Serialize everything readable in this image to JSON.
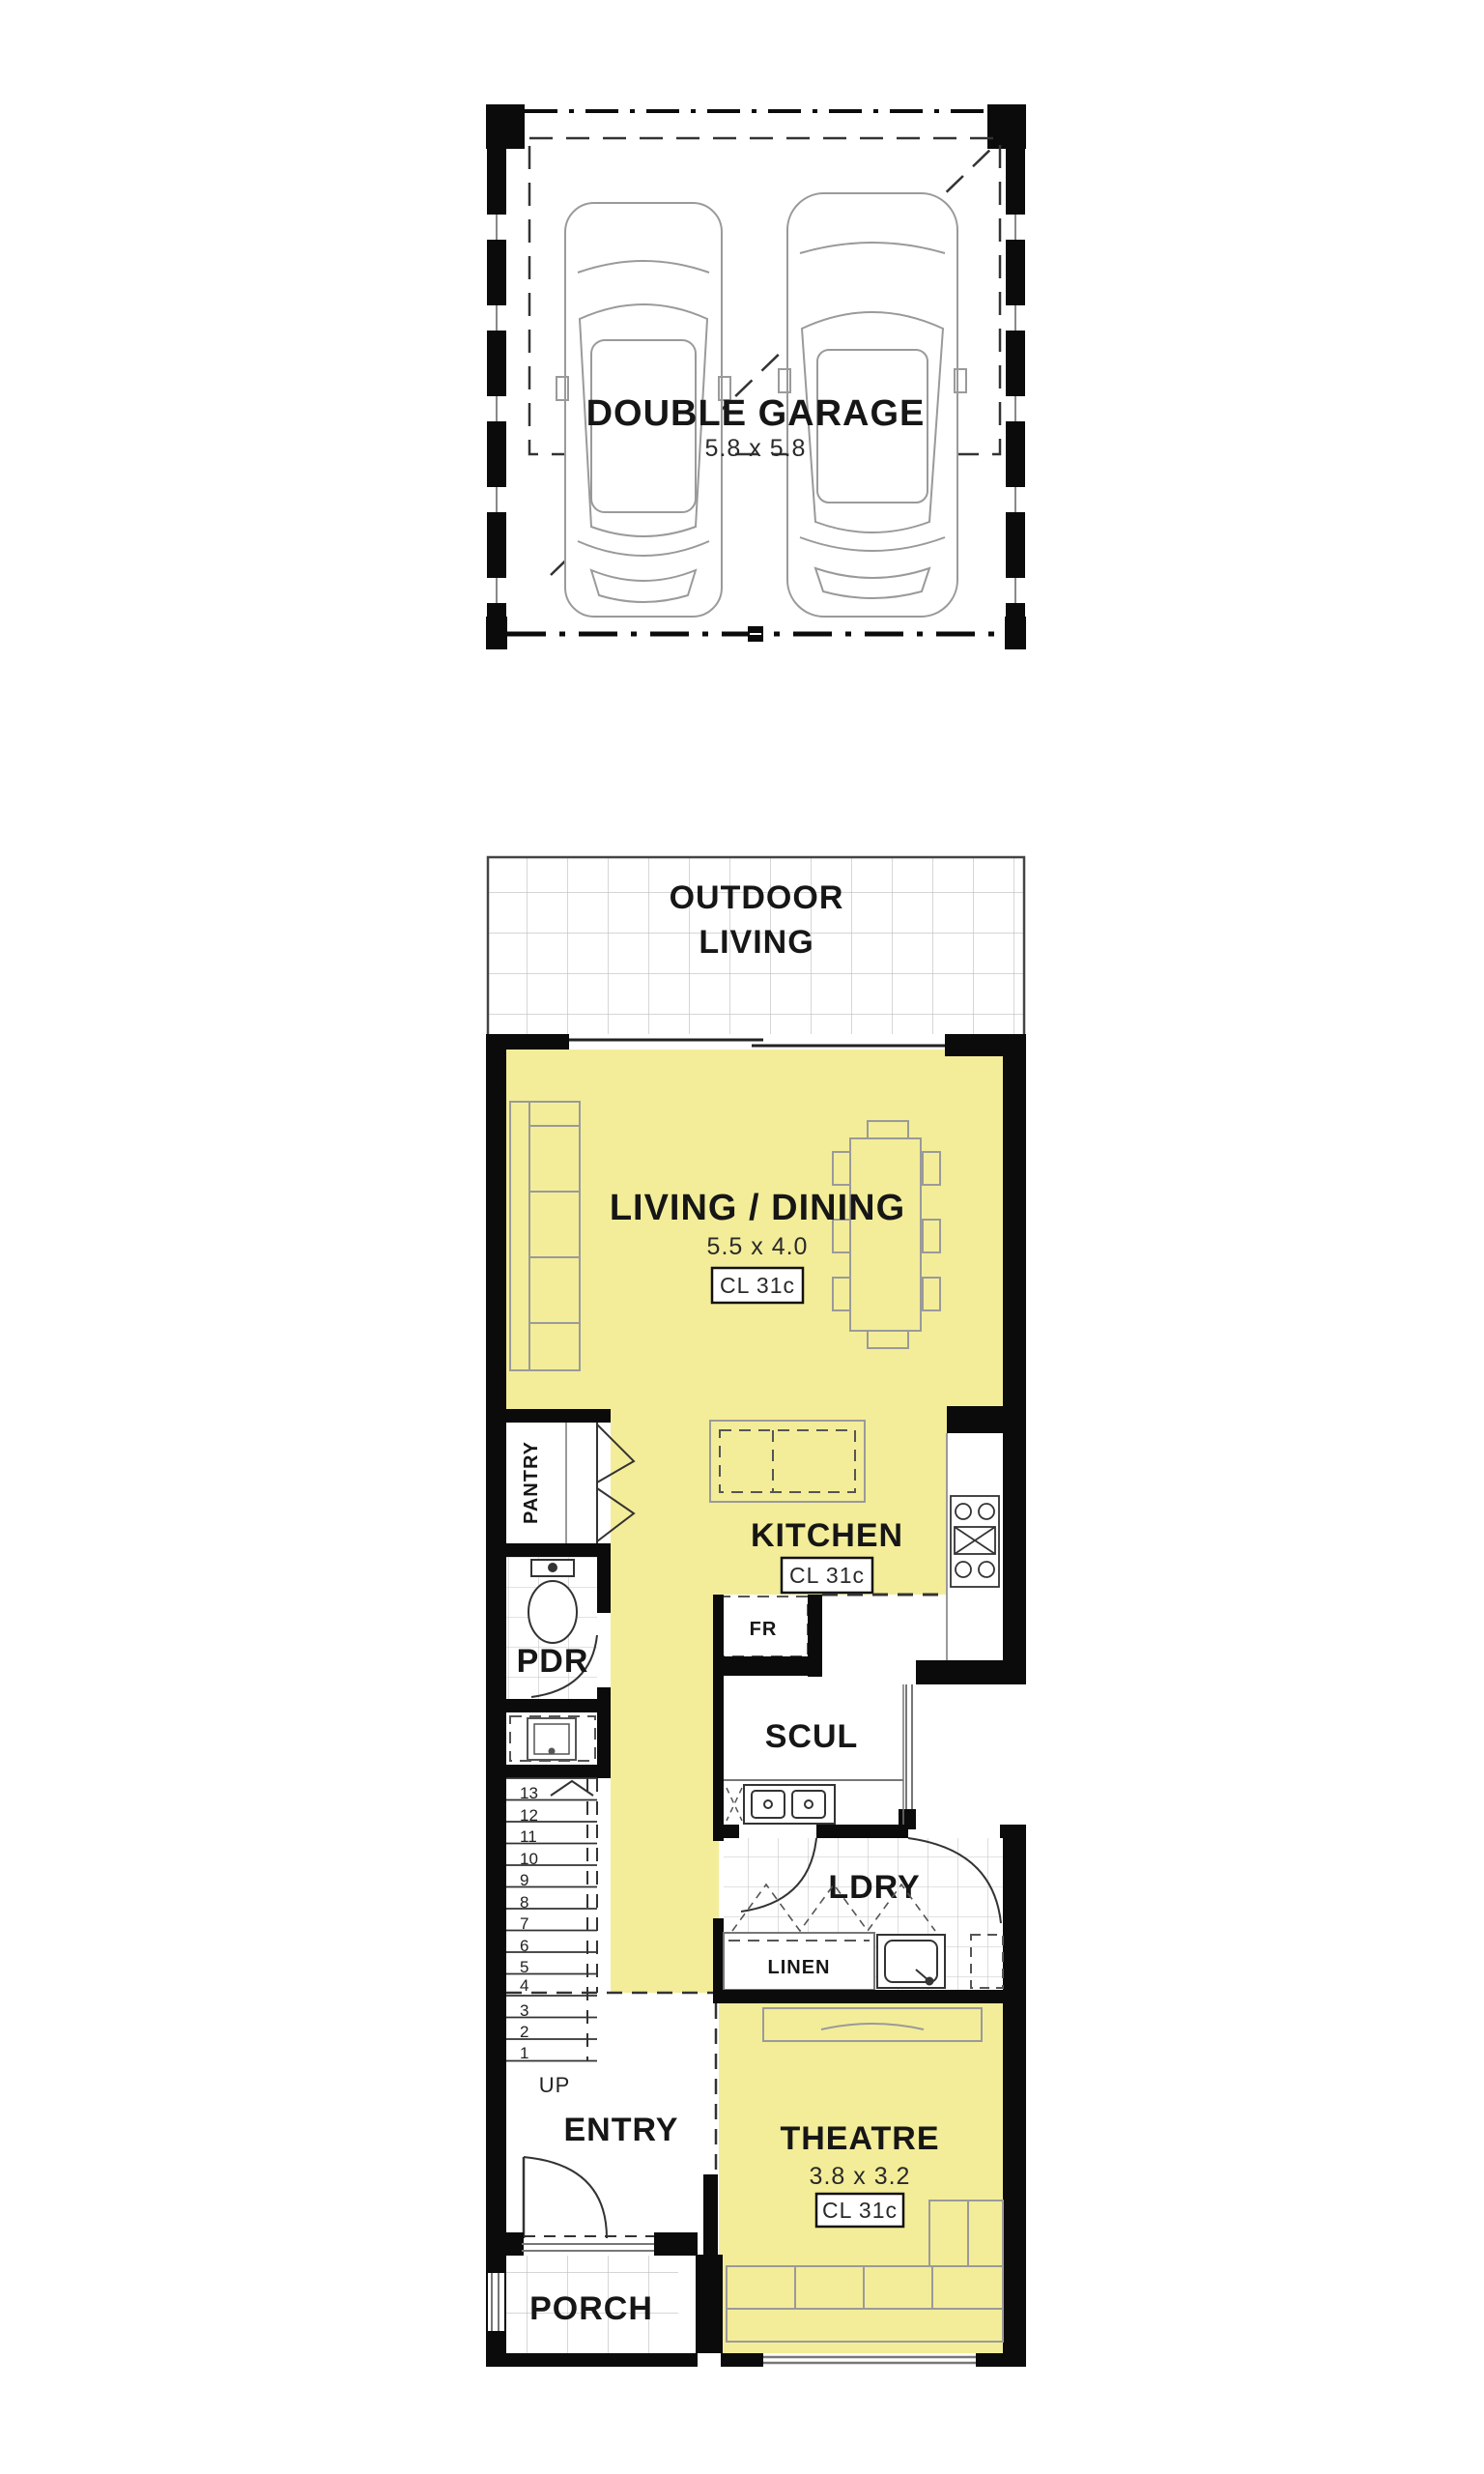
{
  "plan": {
    "garage": {
      "name": "DOUBLE GARAGE",
      "dims": "5.8 x 5.8"
    },
    "outdoor_living": {
      "line1": "OUTDOOR",
      "line2": "LIVING"
    },
    "living_dining": {
      "name": "LIVING / DINING",
      "dims": "5.5 x 4.0",
      "cl": "CL 31c"
    },
    "kitchen": {
      "name": "KITCHEN",
      "cl": "CL 31c"
    },
    "pantry": {
      "name": "PANTRY"
    },
    "pdr": {
      "name": "PDR"
    },
    "fridge": {
      "name": "FR"
    },
    "scullery": {
      "name": "SCUL"
    },
    "laundry": {
      "name": "LDRY"
    },
    "linen": {
      "name": "LINEN"
    },
    "stairs": {
      "up": "UP",
      "treads": [
        "13",
        "12",
        "11",
        "10",
        "9",
        "8",
        "7",
        "6",
        "5",
        "4",
        "3",
        "2",
        "1"
      ]
    },
    "entry": {
      "name": "ENTRY"
    },
    "theatre": {
      "name": "THEATRE",
      "dims": "3.8 x 3.2",
      "cl": "CL 31c"
    },
    "porch": {
      "name": "PORCH"
    },
    "colors": {
      "room_fill": "#F3ED99",
      "wall": "#0B0B0B",
      "tile_line": "#BDBDBD",
      "furniture_line": "#9A9A9A"
    }
  }
}
